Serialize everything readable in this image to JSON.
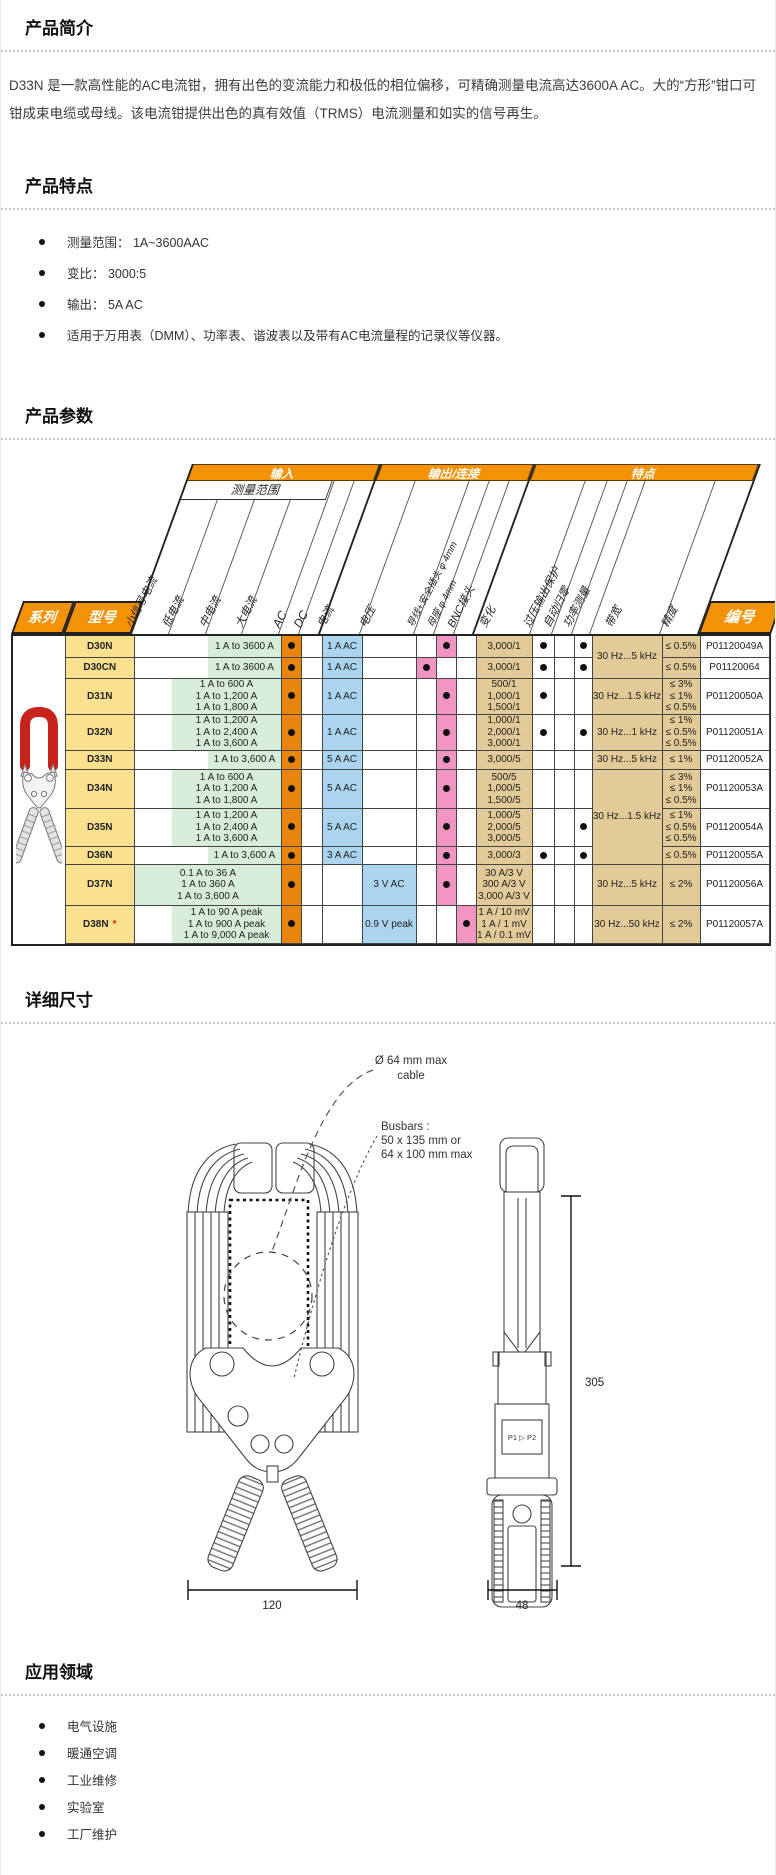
{
  "intro": {
    "title": "产品简介",
    "body": "D33N 是一款高性能的AC电流钳，拥有出色的变流能力和极低的相位偏移，可精确测量电流高达3600A AC。大的“方形”钳口可钳成束电缆或母线。该电流钳提供出色的真有效值（TRMS）电流测量和如实的信号再生。"
  },
  "features": {
    "title": "产品特点",
    "items": [
      "测量范围：  1A~3600AAC",
      "变比：  3000:5",
      "输出：  5A AC",
      "适用于万用表（DMM）、功率表、谐波表以及带有AC电流量程的记录仪等仪器。"
    ]
  },
  "params": {
    "title": "产品参数"
  },
  "table": {
    "groups": {
      "input": "输入",
      "output": "输出/连接",
      "feat": "特点"
    },
    "measure_range": "测量范围",
    "star_note": "*",
    "columns": {
      "series": "系列",
      "model": "型号",
      "small_signal": "小信号电流",
      "low_current": "低电流",
      "mid_current": "中电流",
      "high_current": "大电流",
      "ac": "AC",
      "dc": "DC",
      "current": "电流",
      "voltage": "电压",
      "lead": "导线+安全插头  φ 4mm",
      "socket": "母座 φ 4mm",
      "bnc": "BNC接头",
      "ratio": "变化",
      "ovp": "过压输出保护",
      "autozero": "自动归零",
      "power": "功率测量",
      "bandwidth": "带宽",
      "accuracy": "精度",
      "part": "编号"
    },
    "rows": [
      {
        "model": "D30N",
        "star": false,
        "ranges": [
          "1 A to 3600 A"
        ],
        "mint": "mh",
        "ac": true,
        "current": "1 A AC",
        "voltage": "",
        "conn": "socket",
        "ratio": [
          "3,000/1"
        ],
        "ovp": true,
        "power": true,
        "bw": "30 Hz...5 kHz",
        "bw_rows": 2,
        "acc": [
          "≤ 0.5%"
        ],
        "part": "P01120049A"
      },
      {
        "model": "D30CN",
        "star": false,
        "ranges": [
          "1 A to 3600 A"
        ],
        "mint": "mh",
        "ac": true,
        "current": "1 A AC",
        "voltage": "",
        "conn": "lead",
        "ratio": [
          "3,000/1"
        ],
        "ovp": true,
        "power": true,
        "bw": null,
        "acc": [
          "≤ 0.5%"
        ],
        "part": "P01120064"
      },
      {
        "model": "D31N",
        "star": false,
        "ranges": [
          "1 A to 600 A",
          "1 A to 1,200 A",
          "1 A to 1,800 A"
        ],
        "mint": "lmh",
        "ac": true,
        "current": "1 A AC",
        "voltage": "",
        "conn": "socket",
        "ratio": [
          "500/1",
          "1,000/1",
          "1,500/1"
        ],
        "ovp": true,
        "power": false,
        "bw": "30 Hz...1.5 kHz",
        "bw_rows": 1,
        "acc": [
          "≤ 3%",
          "≤ 1%",
          "≤ 0.5%"
        ],
        "part": "P01120050A"
      },
      {
        "model": "D32N",
        "star": false,
        "ranges": [
          "1 A to 1,200 A",
          "1 A to 2,400 A",
          "1 A to 3,600 A"
        ],
        "mint": "lmh",
        "ac": true,
        "current": "1 A AC",
        "voltage": "",
        "conn": "socket",
        "ratio": [
          "1,000/1",
          "2,000/1",
          "3,000/1"
        ],
        "ovp": true,
        "power": true,
        "bw": "30 Hz...1 kHz",
        "bw_rows": 1,
        "acc": [
          "≤ 1%",
          "≤ 0.5%",
          "≤ 0.5%"
        ],
        "part": "P01120051A"
      },
      {
        "model": "D33N",
        "star": false,
        "ranges": [
          "1 A to 3,600 A"
        ],
        "mint": "mh",
        "ac": true,
        "current": "5 A AC",
        "voltage": "",
        "conn": "socket",
        "ratio": [
          "3,000/5"
        ],
        "ovp": false,
        "power": false,
        "bw": "30 Hz...5 kHz",
        "bw_rows": 1,
        "acc": [
          "≤ 1%"
        ],
        "part": "P01120052A"
      },
      {
        "model": "D34N",
        "star": false,
        "ranges": [
          "1 A to 600 A",
          "1 A to 1,200 A",
          "1 A to 1,800 A"
        ],
        "mint": "lmh",
        "ac": true,
        "current": "5 A AC",
        "voltage": "",
        "conn": "socket",
        "ratio": [
          "500/5",
          "1,000/5",
          "1,500/5"
        ],
        "ovp": false,
        "power": false,
        "bw": "30 Hz...1.5 kHz",
        "bw_rows": 3,
        "acc": [
          "≤ 3%",
          "≤ 1%",
          "≤ 0.5%"
        ],
        "part": "P01120053A"
      },
      {
        "model": "D35N",
        "star": false,
        "ranges": [
          "1 A to 1,200 A",
          "1 A to 2,400 A",
          "1 A to 3,600 A"
        ],
        "mint": "lmh",
        "ac": true,
        "current": "5 A AC",
        "voltage": "",
        "conn": "socket",
        "ratio": [
          "1,000/5",
          "2,000/5",
          "3,000/5"
        ],
        "ovp": false,
        "power": true,
        "bw": null,
        "acc": [
          "≤ 1%",
          "≤ 0.5%",
          "≤ 0.5%"
        ],
        "part": "P01120054A"
      },
      {
        "model": "D36N",
        "star": false,
        "ranges": [
          "1 A to 3,600 A"
        ],
        "mint": "mh",
        "ac": true,
        "current": "3 A AC",
        "voltage": "",
        "conn": "socket",
        "ratio": [
          "3,000/3"
        ],
        "ovp": true,
        "power": true,
        "bw": null,
        "acc": [
          "≤ 0.5%"
        ],
        "part": "P01120055A"
      },
      {
        "model": "D37N",
        "star": false,
        "ranges": [
          "0.1 A to 36 A",
          "1 A to 360 A",
          "1 A to 3,600 A"
        ],
        "mint": "all",
        "ac": true,
        "current": "",
        "voltage": "3 V AC",
        "conn": "socket",
        "ratio": [
          "30 A/3 V",
          "300 A/3 V",
          "3,000 A/3 V"
        ],
        "ovp": false,
        "power": false,
        "bw": "30 Hz...5 kHz",
        "bw_rows": 1,
        "acc": [
          "≤ 2%"
        ],
        "part": "P01120056A"
      },
      {
        "model": "D38N",
        "star": true,
        "ranges": [
          "1 A to 90 A peak",
          "1 A to 900 A peak",
          "1 A to 9,000 A peak"
        ],
        "mint": "lmh",
        "ac": true,
        "current": "",
        "voltage": "0.9 V peak",
        "conn": "bnc",
        "ratio": [
          "1 A / 10 mV",
          "1 A / 1 mV",
          "1 A / 0.1 mV"
        ],
        "ovp": false,
        "power": false,
        "bw": "30 Hz...50 kHz",
        "bw_rows": 1,
        "acc": [
          "≤ 2%"
        ],
        "part": "P01120057A"
      }
    ]
  },
  "dims": {
    "title": "详细尺寸",
    "cable_label_1": "Ø 64 mm max",
    "cable_label_2": "cable",
    "busbars_1": "Busbars :",
    "busbars_2": "50 x 135 mm or",
    "busbars_3": "64 x 100 mm max",
    "height": "305",
    "front_width": "120",
    "side_width": "48",
    "panel": "P1 ▷ P2"
  },
  "apps": {
    "title": "应用领域",
    "items": [
      "电气设施",
      "暖通空调",
      "工业维修",
      "实验室",
      "工厂维护"
    ]
  },
  "colors": {
    "orange": "#F29204",
    "ac_orange": "#EA850B",
    "yellow": "#FBE18F",
    "mint": "#D8ECDA",
    "blue": "#ABD4EF",
    "pink": "#F295C2",
    "tan": "#E2CB98",
    "red": "#D81E05",
    "clamp_red": "#C5231B"
  }
}
